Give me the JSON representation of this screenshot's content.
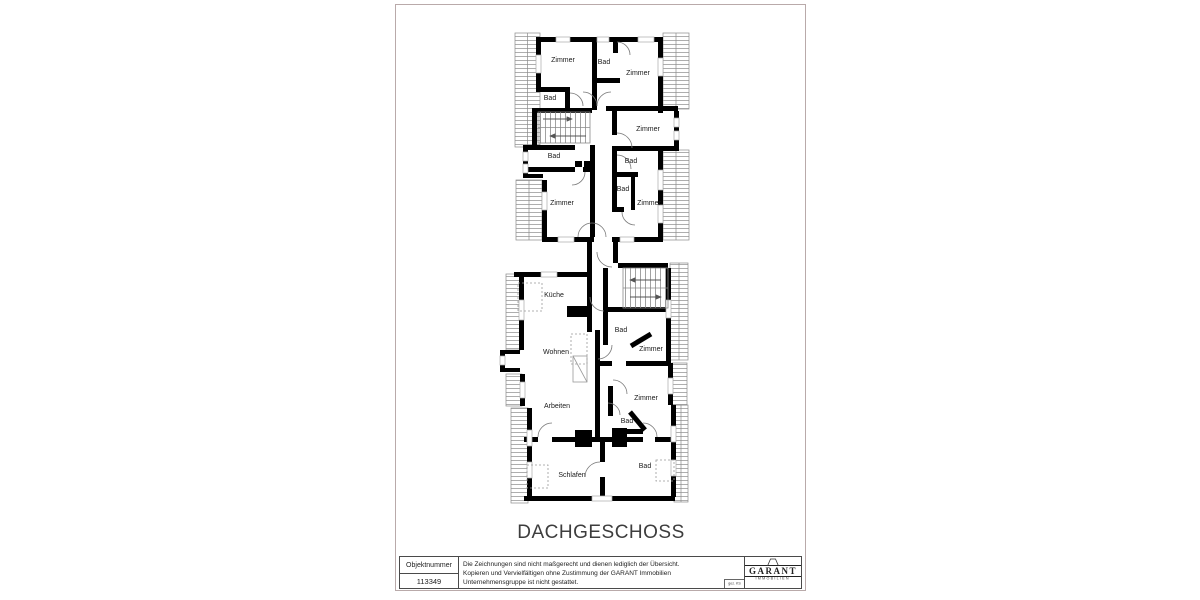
{
  "page": {
    "floor_title": "DACHGESCHOSS"
  },
  "title_block": {
    "object_number_label": "Objektnummer",
    "object_number_value": "113349",
    "disclaimer_lines": [
      "Die Zeichnungen sind nicht maßgerecht und dienen lediglich der Übersicht.",
      "Kopieren und Vervielfältigen ohne Zustimmung der GARANT Immobilien",
      "Unternehmensgruppe ist nicht gestattet."
    ],
    "signature_note": "gez. KS",
    "logo": {
      "brand": "GARANT",
      "subtitle": "IMMOBILIEN"
    }
  },
  "floorplan": {
    "room_labels": [
      {
        "text": "Zimmer",
        "x": 563,
        "y": 60
      },
      {
        "text": "Bad",
        "x": 604,
        "y": 62
      },
      {
        "text": "Zimmer",
        "x": 638,
        "y": 73
      },
      {
        "text": "Bad",
        "x": 550,
        "y": 98
      },
      {
        "text": "Zimmer",
        "x": 648,
        "y": 129
      },
      {
        "text": "Bad",
        "x": 554,
        "y": 156
      },
      {
        "text": "Bad",
        "x": 631,
        "y": 161
      },
      {
        "text": "Bad",
        "x": 623,
        "y": 189
      },
      {
        "text": "Zimmer",
        "x": 562,
        "y": 203
      },
      {
        "text": "Zimmer",
        "x": 649,
        "y": 203
      },
      {
        "text": "Küche",
        "x": 554,
        "y": 295
      },
      {
        "text": "Bad",
        "x": 621,
        "y": 330
      },
      {
        "text": "Zimmer",
        "x": 651,
        "y": 349
      },
      {
        "text": "Wohnen",
        "x": 556,
        "y": 352
      },
      {
        "text": "Zimmer",
        "x": 646,
        "y": 398
      },
      {
        "text": "Arbeiten",
        "x": 557,
        "y": 406
      },
      {
        "text": "Bad",
        "x": 627,
        "y": 421
      },
      {
        "text": "Schlafen",
        "x": 572,
        "y": 475
      },
      {
        "text": "Bad",
        "x": 645,
        "y": 466
      }
    ]
  },
  "colors": {
    "wall": "#000000",
    "thin_line": "#777777",
    "hatch_line": "#999999",
    "page_border": "#b9aaaa",
    "text": "#222222"
  }
}
